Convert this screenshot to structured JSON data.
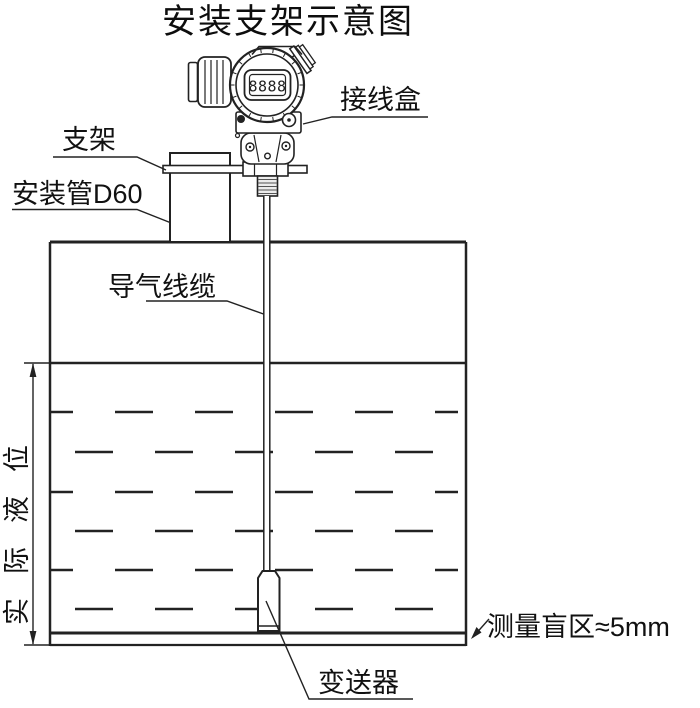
{
  "title": "安装支架示意图",
  "labels": {
    "junction_box": "接线盒",
    "bracket": "支架",
    "mounting_pipe": "安装管D60",
    "air_cable": "导气线缆",
    "actual_level": "实际液位",
    "blind_zone": "测量盲区≈5mm",
    "transmitter": "变送器"
  },
  "instrument": {
    "display_digits": "8888"
  },
  "colors": {
    "line": "#222222",
    "text": "#111111",
    "background": "#ffffff"
  }
}
